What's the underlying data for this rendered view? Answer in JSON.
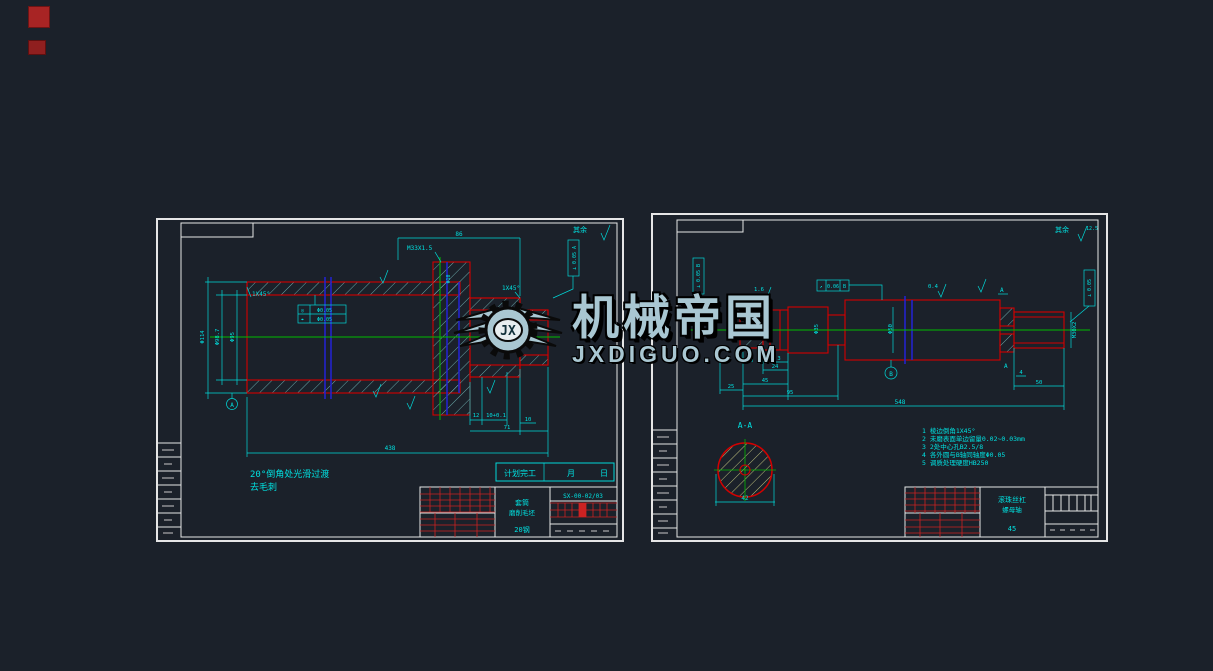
{
  "canvas": {
    "bg": "#1b212a",
    "corner_mark_color": "#b02525"
  },
  "watermark": {
    "brand": "机械帝国",
    "site": "JXDIGUO.COM",
    "monogram": "JX",
    "color": "#a9c7d2"
  },
  "left_sheet": {
    "corner_note": "其余",
    "dims": {
      "phi114": "Φ114",
      "phi98": "Φ98.7",
      "phi95": "Φ95",
      "phi10": "Φ10",
      "chamfer_left": "1X45°",
      "chamfer_right": "1X45°",
      "thread": "M33X1.5",
      "top_len": "86",
      "d12": "12",
      "d10_tol": "10+0.1",
      "d10": "10",
      "d71": "71",
      "d438": "438"
    },
    "tolerances": {
      "frame_sym1": "◎",
      "frame_val1": "Φ0.05",
      "frame_sym2": "⌖",
      "frame_val2": "Φ0.05",
      "right_box": "⊥ 0.05 A"
    },
    "datum_a": "A",
    "process_note_1": "20°倒角处光滑过渡",
    "process_note_2": "去毛刺",
    "plan": {
      "label": "计划完工",
      "month": "月",
      "day": "日"
    },
    "title_block": {
      "drawing_no": "SX-00-02/03",
      "name1": "套筒",
      "name2": "磨削毛坯",
      "material": "20钢"
    }
  },
  "right_sheet": {
    "corner_note": "其余",
    "corner_value": "12.5",
    "dims": {
      "phi35": "Φ35",
      "phi50": "Φ50",
      "thread": "M30X2",
      "d3": "3",
      "d24": "24",
      "d45": "45",
      "d95": "95",
      "d10": "10",
      "d25": "25",
      "d548": "548",
      "d4": "4",
      "d50": "50"
    },
    "roughness": {
      "r16": "1.6",
      "r04": "0.4"
    },
    "tolerances": {
      "left_box": "⊥ 0.05 B",
      "mid_sym": "↗",
      "mid_value": "0.06",
      "mid_datum": "B",
      "right_box": "⊥ 0.05"
    },
    "datums": {
      "a1": "A",
      "a2": "A",
      "b": "B"
    },
    "section": {
      "label": "A-A",
      "dim": "42"
    },
    "notes": [
      "1 棱边倒角1X45°",
      "2 未磨表面单边留量0.02~0.03mm",
      "3 2处中心孔B2.5/8",
      "4 各外圆与B轴同轴度Φ0.05",
      "5 调质处理硬度HB250"
    ],
    "title_block": {
      "name1": "滚珠丝杠",
      "name2": "螺母轴",
      "material": "45"
    }
  }
}
